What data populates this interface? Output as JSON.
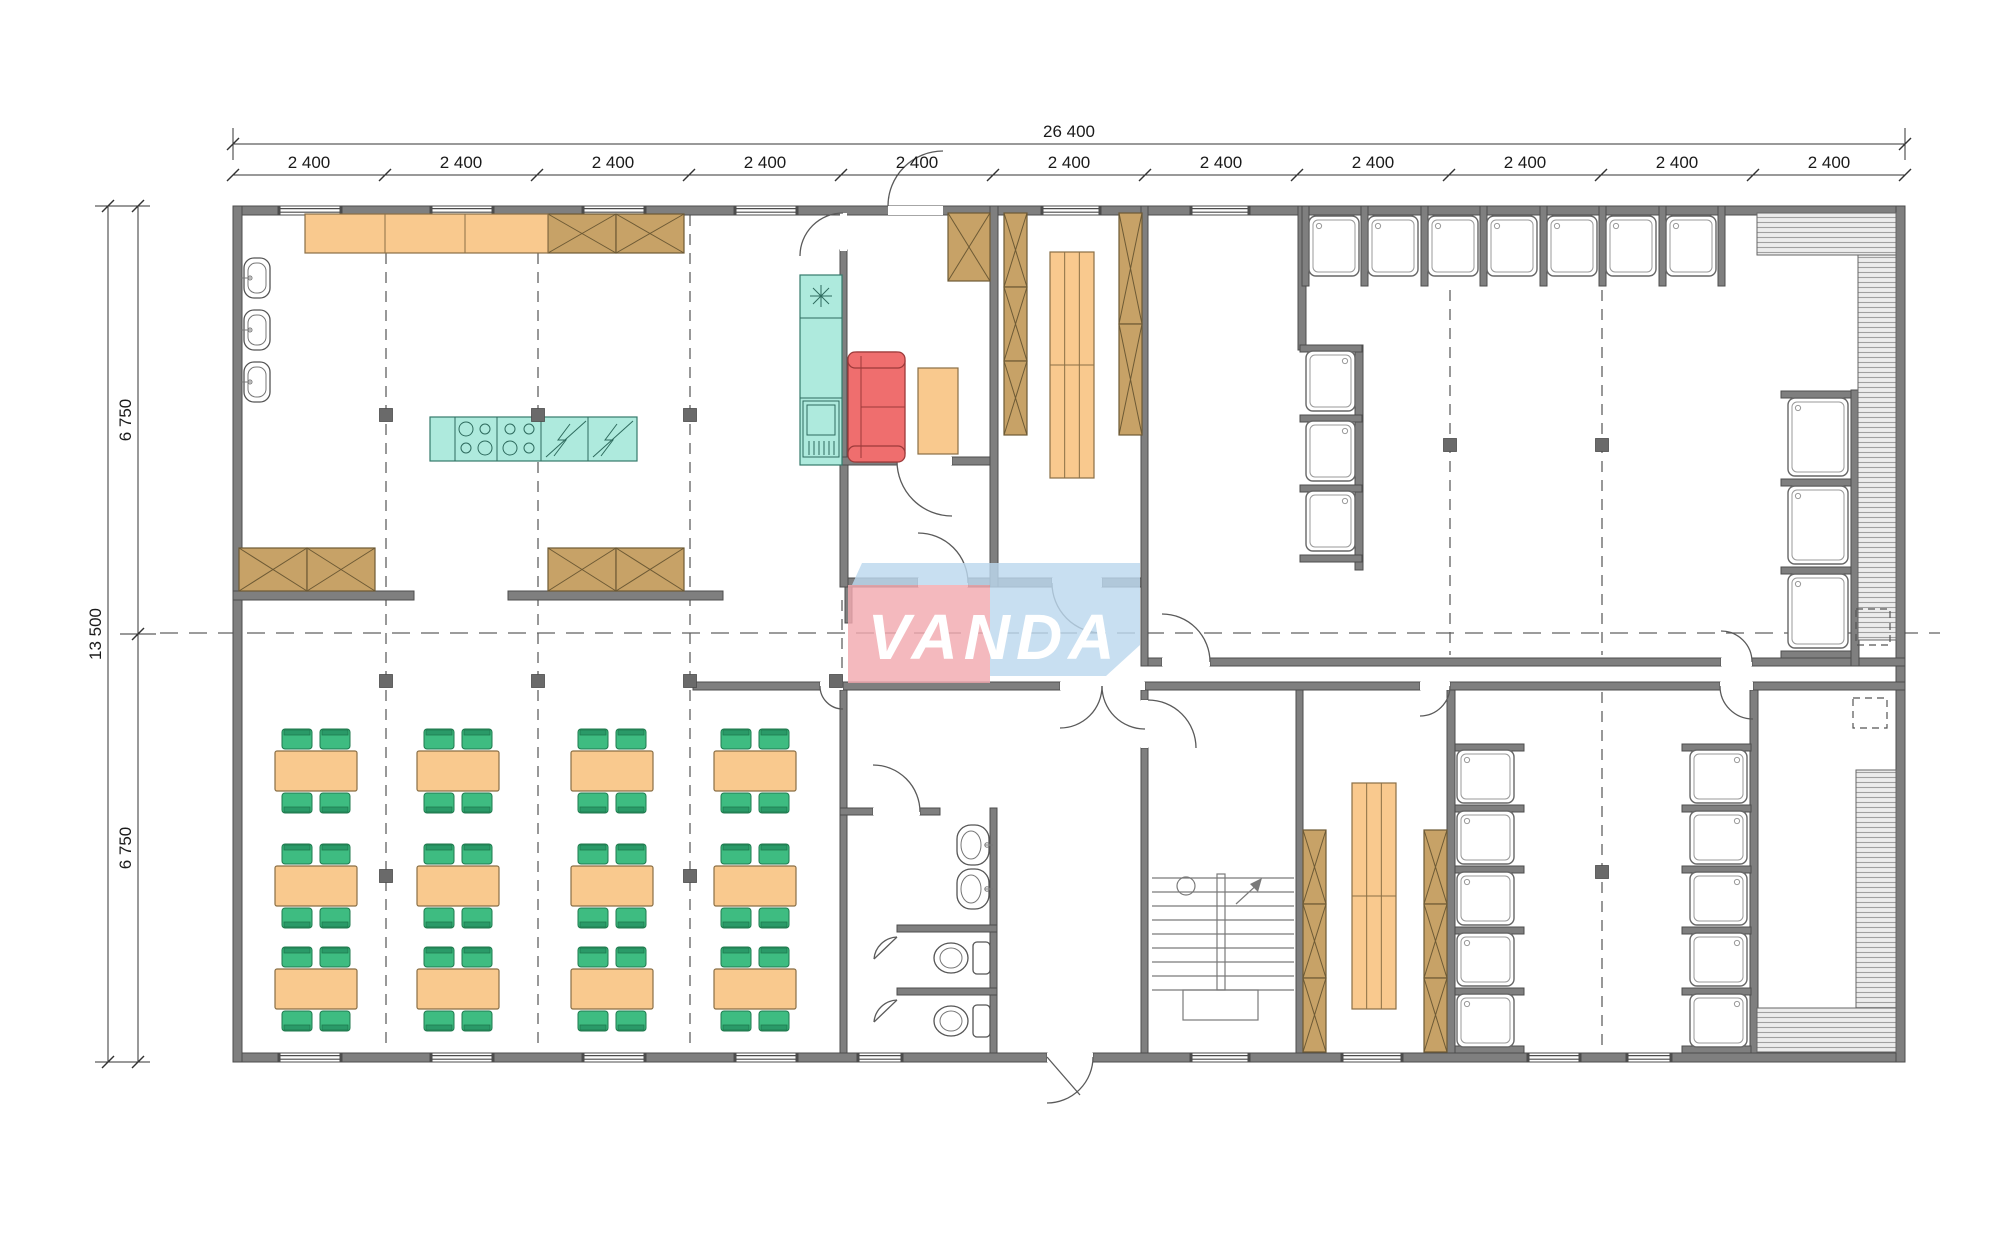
{
  "watermark": {
    "text": "VANDA",
    "pink": "#f2aab0",
    "blue": "#bcd8ee"
  },
  "dimensions": {
    "top": {
      "total": "26 400",
      "segments": [
        "2 400",
        "2 400",
        "2 400",
        "2 400",
        "2 400",
        "2 400",
        "2 400",
        "2 400",
        "2 400",
        "2 400",
        "2 400"
      ]
    },
    "left": {
      "total": "13 500",
      "segments": [
        "6 750",
        "6 750"
      ]
    }
  },
  "colors": {
    "wall": "#7f7f7f",
    "furniture_orange": "#f9c98e",
    "cabinet_brown": "#c7a267",
    "kitchen_teal": "#aeeadd",
    "sofa_red": "#ef6e6e",
    "chair_green": "#3ebc81"
  },
  "plan": {
    "grid": {
      "v": [
        [
          386,
          215,
          1050
        ],
        [
          538,
          215,
          1050
        ],
        [
          690,
          215,
          1050
        ],
        [
          842,
          600,
          680
        ],
        [
          1450,
          290,
          655
        ],
        [
          1602,
          290,
          655
        ],
        [
          1602,
          692,
          1050
        ]
      ],
      "h": [
        [
          633,
          160,
          1940
        ]
      ],
      "markers": [
        [
          386,
          415
        ],
        [
          538,
          415
        ],
        [
          690,
          415
        ],
        [
          1450,
          445
        ],
        [
          1602,
          445
        ],
        [
          386,
          681
        ],
        [
          538,
          681
        ],
        [
          690,
          681
        ],
        [
          836,
          681
        ],
        [
          386,
          876
        ],
        [
          690,
          876
        ],
        [
          1602,
          872
        ]
      ]
    },
    "walls": [
      [
        233,
        206,
        1672,
        9
      ],
      [
        233,
        1053,
        814,
        9
      ],
      [
        1093,
        1053,
        812,
        9
      ],
      [
        233,
        206,
        9,
        856
      ],
      [
        1896,
        206,
        9,
        856
      ],
      [
        233,
        591,
        181,
        9
      ],
      [
        508,
        591,
        215,
        9
      ],
      [
        840,
        250,
        7,
        215
      ],
      [
        840,
        457,
        57,
        8
      ],
      [
        952,
        457,
        46,
        8
      ],
      [
        990,
        206,
        8,
        381
      ],
      [
        848,
        578,
        70,
        9
      ],
      [
        968,
        578,
        22,
        9
      ],
      [
        998,
        578,
        54,
        9
      ],
      [
        1102,
        578,
        46,
        9
      ],
      [
        840,
        465,
        8,
        122
      ],
      [
        845,
        587,
        7,
        36
      ],
      [
        1141,
        206,
        7,
        460
      ],
      [
        1148,
        658,
        14,
        8
      ],
      [
        1210,
        658,
        511,
        8
      ],
      [
        1752,
        658,
        153,
        8
      ],
      [
        693,
        682,
        127,
        8
      ],
      [
        843,
        682,
        217,
        8
      ],
      [
        1145,
        682,
        275,
        8
      ],
      [
        1450,
        682,
        270,
        8
      ],
      [
        1753,
        682,
        152,
        8
      ],
      [
        840,
        690,
        7,
        363
      ],
      [
        840,
        808,
        33,
        7
      ],
      [
        920,
        808,
        20,
        7
      ],
      [
        990,
        808,
        7,
        245
      ],
      [
        897,
        925,
        100,
        7
      ],
      [
        897,
        988,
        100,
        7
      ],
      [
        1141,
        690,
        7,
        10
      ],
      [
        1141,
        748,
        7,
        305
      ],
      [
        1296,
        690,
        7,
        363
      ],
      [
        1447,
        690,
        8,
        363
      ],
      [
        1750,
        690,
        8,
        363
      ],
      [
        1298,
        206,
        8,
        144
      ],
      [
        1355,
        345,
        8,
        225
      ],
      [
        1851,
        390,
        8,
        276
      ]
    ],
    "stubs": [
      [
        1302,
        206,
        7,
        80
      ],
      [
        1361,
        206,
        7,
        80
      ],
      [
        1421,
        206,
        7,
        80
      ],
      [
        1480,
        206,
        7,
        80
      ],
      [
        1540,
        206,
        7,
        80
      ],
      [
        1599,
        206,
        7,
        80
      ],
      [
        1659,
        206,
        7,
        80
      ],
      [
        1718,
        206,
        7,
        80
      ],
      [
        1300,
        345,
        62,
        7
      ],
      [
        1300,
        415,
        62,
        7
      ],
      [
        1300,
        485,
        62,
        7
      ],
      [
        1300,
        555,
        62,
        7
      ],
      [
        1781,
        391,
        70,
        7
      ],
      [
        1781,
        479,
        70,
        7
      ],
      [
        1781,
        567,
        70,
        7
      ],
      [
        1781,
        651,
        70,
        7
      ],
      [
        1455,
        744,
        69,
        7
      ],
      [
        1455,
        805,
        69,
        7
      ],
      [
        1455,
        866,
        69,
        7
      ],
      [
        1455,
        927,
        69,
        7
      ],
      [
        1455,
        988,
        69,
        7
      ],
      [
        1455,
        1046,
        69,
        7
      ],
      [
        1682,
        744,
        69,
        7
      ],
      [
        1682,
        805,
        69,
        7
      ],
      [
        1682,
        866,
        69,
        7
      ],
      [
        1682,
        927,
        69,
        7
      ],
      [
        1682,
        988,
        69,
        7
      ],
      [
        1682,
        1046,
        69,
        7
      ]
    ],
    "windows": [
      [
        279,
        206,
        62
      ],
      [
        431,
        206,
        62
      ],
      [
        583,
        206,
        62
      ],
      [
        735,
        206,
        62
      ],
      [
        1042,
        206,
        58
      ],
      [
        1191,
        206,
        58
      ],
      [
        279,
        1053,
        62
      ],
      [
        431,
        1053,
        62
      ],
      [
        583,
        1053,
        62
      ],
      [
        735,
        1053,
        62
      ],
      [
        858,
        1053,
        44
      ],
      [
        1191,
        1053,
        58
      ],
      [
        1342,
        1053,
        60
      ],
      [
        1528,
        1053,
        52
      ],
      [
        1627,
        1053,
        44
      ]
    ],
    "door_gaps": [
      [
        888,
        206,
        55,
        9
      ],
      [
        840,
        213,
        7,
        38
      ],
      [
        897,
        457,
        55,
        8
      ],
      [
        918,
        578,
        50,
        9
      ],
      [
        1052,
        578,
        50,
        9
      ],
      [
        820,
        682,
        23,
        8
      ],
      [
        1060,
        682,
        85,
        8
      ],
      [
        873,
        808,
        47,
        7
      ],
      [
        1141,
        700,
        7,
        48
      ],
      [
        1162,
        658,
        48,
        8
      ],
      [
        1721,
        658,
        31,
        8
      ],
      [
        1420,
        682,
        30,
        8
      ],
      [
        1720,
        682,
        33,
        8
      ],
      [
        1047,
        1053,
        46,
        9
      ]
    ],
    "door_arcs": [
      "M 888 206 A 55 55 0 0 1 943 151",
      "M 843 213 A 43 43 0 0 0 800 256",
      "M 897 461 A 55 55 0 0 0 952 516",
      "M 968 583 A 50 50 0 0 0 918 533",
      "M 1052 583 A 50 50 0 0 0 1102 633",
      "M 820 686 A 23 23 0 0 0 843 709",
      "M 1060 728 A 42 42 0 0 0 1102 686",
      "M 1145 729 A 43 43 0 0 1 1102 686",
      "M 920 812 A 47 47 0 0 0 873 765",
      "M 1148 700 A 48 48 0 0 1 1196 748",
      "M 1210 662 A 48 48 0 0 0 1162 614",
      "M 1752 662 A 31 31 0 0 0 1721 631",
      "M 1450 686 A 30 30 0 0 1 1420 716",
      "M 1720 686 A 33 33 0 0 0 1753 719",
      "M 1093 1057 A 46 46 0 0 1 1047 1103",
      "M 897 937 A 24 24 0 0 0 874 959",
      "M 897 1000 A 24 24 0 0 0 874 1022"
    ],
    "door_leaves": [
      [
        1047,
        1057,
        1080,
        1095
      ],
      [
        897,
        937,
        874,
        959
      ],
      [
        897,
        1000,
        874,
        1022
      ]
    ],
    "xboxes": [
      [
        548,
        214,
        68,
        39
      ],
      [
        616,
        214,
        68,
        39
      ],
      [
        239,
        548,
        68,
        43
      ],
      [
        307,
        548,
        68,
        43
      ],
      [
        548,
        548,
        68,
        43
      ],
      [
        616,
        548,
        68,
        43
      ],
      [
        948,
        213,
        42,
        68
      ],
      [
        1004,
        213,
        23,
        74
      ],
      [
        1004,
        287,
        23,
        74
      ],
      [
        1004,
        361,
        23,
        74
      ],
      [
        1119,
        213,
        23,
        111
      ],
      [
        1119,
        324,
        23,
        111
      ],
      [
        1303,
        830,
        23,
        74
      ],
      [
        1303,
        904,
        23,
        74
      ],
      [
        1303,
        978,
        23,
        74
      ],
      [
        1424,
        830,
        23,
        74
      ],
      [
        1424,
        904,
        23,
        74
      ],
      [
        1424,
        978,
        23,
        74
      ]
    ],
    "counter": {
      "r": [
        305,
        214,
        243,
        39
      ],
      "div": [
        385,
        465
      ]
    },
    "orects": [
      [
        918,
        368,
        40,
        86
      ]
    ],
    "shelves": [
      [
        1050,
        252,
        44,
        226
      ],
      [
        1352,
        783,
        44,
        226
      ]
    ],
    "trays": [
      [
        1309,
        216,
        50,
        60,
        "tl"
      ],
      [
        1368,
        216,
        50,
        60,
        "tl"
      ],
      [
        1428,
        216,
        50,
        60,
        "tl"
      ],
      [
        1487,
        216,
        50,
        60,
        "tl"
      ],
      [
        1547,
        216,
        50,
        60,
        "tl"
      ],
      [
        1606,
        216,
        50,
        60,
        "tl"
      ],
      [
        1666,
        216,
        50,
        60,
        "tl"
      ],
      [
        1306,
        351,
        49,
        60,
        "tr"
      ],
      [
        1306,
        421,
        49,
        60,
        "tr"
      ],
      [
        1306,
        491,
        49,
        60,
        "tr"
      ],
      [
        1788,
        398,
        60,
        78,
        "tl"
      ],
      [
        1788,
        486,
        60,
        78,
        "tl"
      ],
      [
        1788,
        574,
        60,
        74,
        "tl"
      ],
      [
        1457,
        750,
        57,
        53,
        "tl"
      ],
      [
        1457,
        811,
        57,
        53,
        "tl"
      ],
      [
        1457,
        872,
        57,
        53,
        "tl"
      ],
      [
        1457,
        933,
        57,
        53,
        "tl"
      ],
      [
        1457,
        994,
        57,
        53,
        "tl"
      ],
      [
        1690,
        750,
        57,
        53,
        "tr"
      ],
      [
        1690,
        811,
        57,
        53,
        "tr"
      ],
      [
        1690,
        872,
        57,
        53,
        "tr"
      ],
      [
        1690,
        933,
        57,
        53,
        "tr"
      ],
      [
        1690,
        994,
        57,
        53,
        "tr"
      ]
    ],
    "tables": {
      "cols": [
        275,
        417,
        571,
        714
      ],
      "rows": [
        751,
        866,
        969
      ],
      "w": 82,
      "h": 40
    },
    "ksinks": {
      "x": 244,
      "ys": [
        258,
        310,
        362
      ],
      "w": 26,
      "h": 40
    },
    "basins": {
      "x": 957,
      "ys": [
        825,
        869
      ],
      "w": 32,
      "h": 40
    },
    "toilets": {
      "ys": [
        942,
        1005
      ]
    },
    "sofa": {
      "r": [
        848,
        352,
        57,
        110
      ]
    },
    "island": {
      "r": [
        430,
        417,
        207,
        44
      ],
      "div": [
        455,
        497,
        541,
        588
      ],
      "burners": [
        [
          466,
          429
        ],
        [
          485,
          429
        ],
        [
          466,
          448
        ],
        [
          485,
          448
        ],
        [
          510,
          429
        ],
        [
          529,
          429
        ],
        [
          510,
          448
        ],
        [
          529,
          448
        ]
      ],
      "diag": [
        [
          586,
          421,
          546,
          457
        ],
        [
          633,
          421,
          593,
          457
        ]
      ],
      "zig": [
        [
          570,
          424,
          558,
          440,
          566,
          440,
          554,
          456
        ],
        [
          617,
          424,
          605,
          440,
          613,
          440,
          601,
          456
        ]
      ]
    },
    "tallunit": {
      "r": [
        800,
        275,
        42,
        190
      ],
      "div": [
        318,
        398
      ],
      "star": [
        821,
        296
      ],
      "fridge": [
        803,
        401,
        36,
        56
      ],
      "fridgein": [
        807,
        405,
        28,
        30
      ]
    },
    "stairs": {
      "treads": [
        878,
        892,
        906,
        920,
        934,
        948,
        962,
        976,
        990
      ],
      "x1": 1152,
      "x2": 1294,
      "stringer": [
        1217,
        874,
        8,
        116
      ],
      "landing": [
        1183,
        990,
        75,
        30
      ],
      "circle": [
        1186,
        886,
        9
      ],
      "arrow": [
        1236,
        904,
        1260,
        882
      ]
    },
    "decks": [
      [
        1757,
        213,
        139,
        42
      ],
      [
        1858,
        255,
        38,
        385
      ],
      [
        1856,
        770,
        40,
        240
      ],
      [
        1757,
        1008,
        139,
        44
      ]
    ],
    "dsquares": [
      [
        1856,
        609,
        34,
        36
      ],
      [
        1853,
        698,
        34,
        30
      ]
    ]
  }
}
